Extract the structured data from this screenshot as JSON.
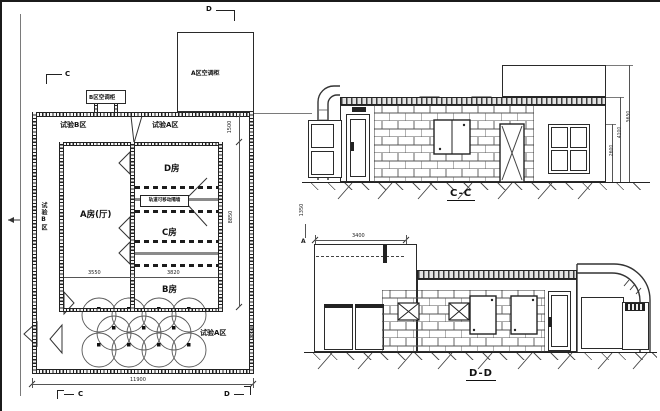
{
  "drawing": {
    "plan": {
      "marker_top": "D",
      "marker_c_top": "C",
      "marker_c_bottom": "C",
      "marker_d_bottom": "D",
      "marker_a_right": "A",
      "ac_cabinet_a": "A区空调柜",
      "ac_cabinet_b": "B区空调柜",
      "zone_b": "试验B区",
      "zone_a": "试验A区",
      "zone_b_side": "试验B区",
      "zone_a_lower": "试验A区",
      "room_a": "A房(厅)",
      "room_b": "B房",
      "room_c": "C房",
      "room_d": "D房",
      "partition_note": "轨道可移动隔墙",
      "dims": {
        "d1500": "1500",
        "d8850": "8850",
        "d3550": "3550",
        "d3820": "3820",
        "d11900": "11900",
        "d1350": "1350",
        "d3350": "3350"
      }
    },
    "section_cc": {
      "label": "C-C",
      "dims": {
        "d2600": "2600",
        "d4100": "4100",
        "d5650": "5650"
      }
    },
    "section_dd": {
      "label": "D-D",
      "dims": {
        "d3400": "3400"
      }
    }
  }
}
